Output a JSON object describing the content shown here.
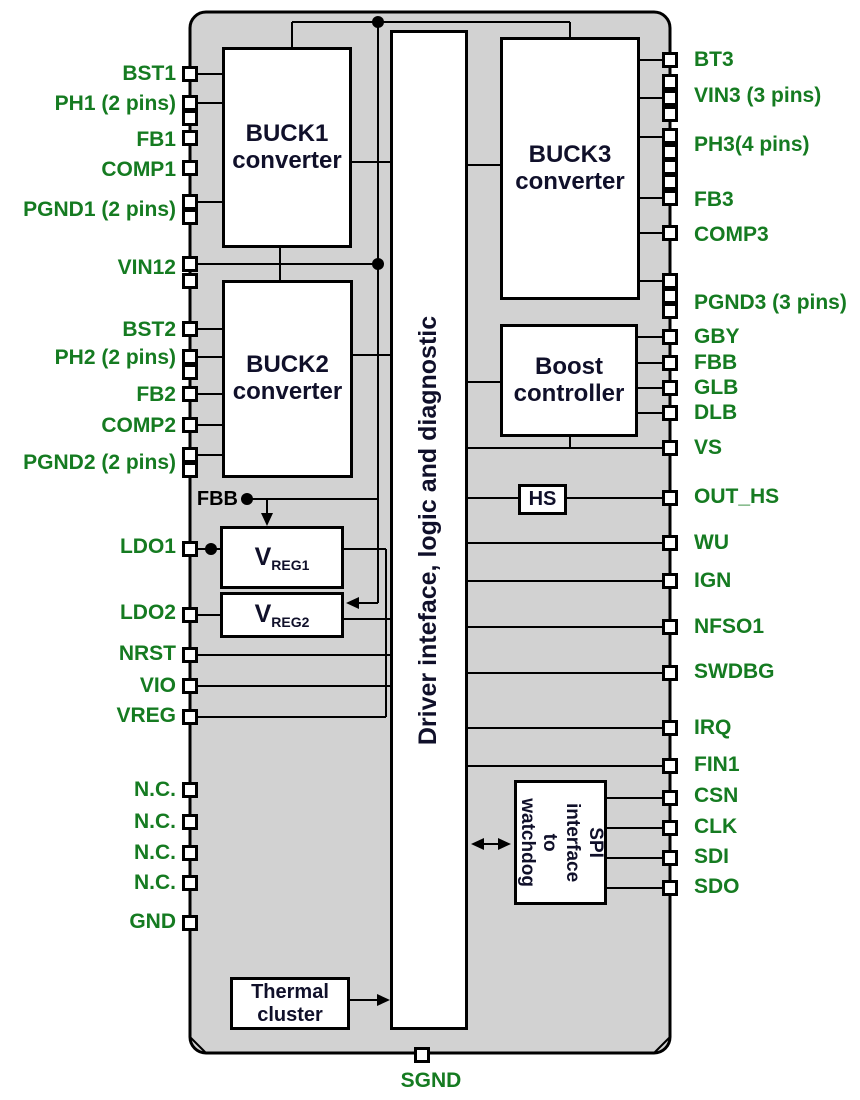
{
  "diagram": {
    "type": "ic-block-diagram",
    "colors": {
      "chip_fill": "#d2d2d2",
      "outline": "#000000",
      "block_fill": "#ffffff",
      "pin_label_green": "#157b21",
      "block_text": "#10102a"
    },
    "chip": {
      "x": 190,
      "y": 12,
      "w": 480,
      "h": 1041,
      "radius": 16
    },
    "blocks": [
      {
        "id": "buck1",
        "kind": "plain",
        "x": 222,
        "y": 47,
        "w": 130,
        "h": 201,
        "cls": "lbl-24",
        "label_lines": [
          "BUCK1",
          "converter"
        ]
      },
      {
        "id": "buck2",
        "kind": "plain",
        "x": 222,
        "y": 280,
        "w": 131,
        "h": 198,
        "cls": "lbl-24",
        "label_lines": [
          "BUCK2",
          "converter"
        ]
      },
      {
        "id": "buck3",
        "kind": "plain",
        "x": 500,
        "y": 37,
        "w": 140,
        "h": 263,
        "cls": "lbl-24",
        "label_lines": [
          "BUCK3",
          "converter"
        ]
      },
      {
        "id": "boost",
        "kind": "plain",
        "x": 500,
        "y": 324,
        "w": 138,
        "h": 113,
        "cls": "lbl-24",
        "label_lines": [
          "Boost",
          "controller"
        ]
      },
      {
        "id": "driver",
        "kind": "rot-ccw",
        "x": 390,
        "y": 30,
        "w": 78,
        "h": 1000,
        "label": "Driver inteface, logic and diagnostic"
      },
      {
        "id": "hs",
        "kind": "plain",
        "x": 518,
        "y": 484,
        "w": 49,
        "h": 31,
        "cls": "lbl-20",
        "label_lines": [
          "HS"
        ]
      },
      {
        "id": "vreg1",
        "kind": "vreg",
        "x": 220,
        "y": 526,
        "w": 124,
        "h": 63,
        "main": "V",
        "sub": "REG1"
      },
      {
        "id": "vreg2",
        "kind": "vreg",
        "x": 220,
        "y": 592,
        "w": 124,
        "h": 46,
        "main": "V",
        "sub": "REG2"
      },
      {
        "id": "spi",
        "kind": "rot-cw",
        "x": 514,
        "y": 780,
        "w": 93,
        "h": 125,
        "label_lines": [
          "SPI interface",
          "to",
          "watchdog"
        ]
      },
      {
        "id": "thermal",
        "kind": "plain",
        "x": 230,
        "y": 977,
        "w": 120,
        "h": 53,
        "cls": "lbl-20",
        "label_lines": [
          "Thermal",
          "cluster"
        ]
      }
    ],
    "pins": {
      "left": [
        {
          "label": "BST1",
          "label_y": 74,
          "squares": [
            74
          ]
        },
        {
          "label": "PH1 (2 pins)",
          "label_y": 104,
          "squares": [
            103,
            118
          ]
        },
        {
          "label": "FB1",
          "label_y": 140,
          "squares": [
            138
          ]
        },
        {
          "label": "COMP1",
          "label_y": 170,
          "squares": [
            168
          ]
        },
        {
          "label": "PGND1 (2 pins)",
          "label_y": 210,
          "squares": [
            202,
            217
          ]
        },
        {
          "label": "VIN12",
          "label_y": 268,
          "squares": [
            264,
            281
          ]
        },
        {
          "label": "BST2",
          "label_y": 330,
          "squares": [
            329
          ]
        },
        {
          "label": "PH2 (2 pins)",
          "label_y": 358,
          "squares": [
            357,
            372
          ]
        },
        {
          "label": "FB2",
          "label_y": 395,
          "squares": [
            394
          ]
        },
        {
          "label": "COMP2",
          "label_y": 426,
          "squares": [
            425
          ]
        },
        {
          "label": "PGND2 (2 pins)",
          "label_y": 463,
          "squares": [
            455,
            470
          ]
        },
        {
          "label": "LDO1",
          "label_y": 547,
          "squares": [
            549
          ]
        },
        {
          "label": "LDO2",
          "label_y": 613,
          "squares": [
            615
          ]
        },
        {
          "label": "NRST",
          "label_y": 654,
          "squares": [
            655
          ]
        },
        {
          "label": "VIO",
          "label_y": 686,
          "squares": [
            686
          ]
        },
        {
          "label": "VREG",
          "label_y": 716,
          "squares": [
            717
          ]
        },
        {
          "label": "N.C.",
          "label_y": 790,
          "squares": [
            790
          ]
        },
        {
          "label": "N.C.",
          "label_y": 822,
          "squares": [
            822
          ]
        },
        {
          "label": "N.C.",
          "label_y": 853,
          "squares": [
            853
          ]
        },
        {
          "label": "N.C.",
          "label_y": 883,
          "squares": [
            883
          ]
        },
        {
          "label": "GND",
          "label_y": 922,
          "squares": [
            923
          ]
        }
      ],
      "right": [
        {
          "label": "BT3",
          "label_y": 60,
          "squares": [
            60
          ]
        },
        {
          "label": "VIN3 (3 pins)",
          "label_y": 96,
          "squares": [
            82,
            98,
            114
          ]
        },
        {
          "label": "PH3(4 pins)",
          "label_y": 145,
          "squares": [
            136,
            152,
            167,
            182
          ]
        },
        {
          "label": "FB3",
          "label_y": 200,
          "squares": [
            198
          ]
        },
        {
          "label": "COMP3",
          "label_y": 235,
          "squares": [
            233
          ]
        },
        {
          "label": "PGND3 (3 pins)",
          "label_y": 303,
          "squares": [
            281,
            296,
            311
          ]
        },
        {
          "label": "GBY",
          "label_y": 337,
          "squares": [
            337
          ]
        },
        {
          "label": "FBB",
          "label_y": 363,
          "squares": [
            363
          ]
        },
        {
          "label": "GLB",
          "label_y": 388,
          "squares": [
            388
          ]
        },
        {
          "label": "DLB",
          "label_y": 413,
          "squares": [
            413
          ]
        },
        {
          "label": "VS",
          "label_y": 448,
          "squares": [
            448
          ]
        },
        {
          "label": "OUT_HS",
          "label_y": 497,
          "squares": [
            498
          ]
        },
        {
          "label": "WU",
          "label_y": 543,
          "squares": [
            543
          ]
        },
        {
          "label": "IGN",
          "label_y": 581,
          "squares": [
            581
          ]
        },
        {
          "label": "NFSO1",
          "label_y": 627,
          "squares": [
            627
          ]
        },
        {
          "label": "SWDBG",
          "label_y": 672,
          "squares": [
            673
          ]
        },
        {
          "label": "IRQ",
          "label_y": 728,
          "squares": [
            728
          ]
        },
        {
          "label": "FIN1",
          "label_y": 765,
          "squares": [
            766
          ]
        },
        {
          "label": "CSN",
          "label_y": 796,
          "squares": [
            798
          ]
        },
        {
          "label": "CLK",
          "label_y": 827,
          "squares": [
            828
          ]
        },
        {
          "label": "SDI",
          "label_y": 857,
          "squares": [
            858
          ]
        },
        {
          "label": "SDO",
          "label_y": 887,
          "squares": [
            888
          ]
        }
      ],
      "bottom": [
        {
          "label": "SGND",
          "label_x": 431,
          "label_y": 1081,
          "square_x": 422,
          "square_y": 1055
        }
      ]
    },
    "inner_labels": [
      {
        "text": "FBB",
        "align_right_x": 238,
        "y": 499
      }
    ],
    "wires": [
      [
        197,
        74,
        222,
        74
      ],
      [
        197,
        103,
        222,
        103
      ],
      [
        197,
        202,
        222,
        202
      ],
      [
        197,
        264,
        378,
        264
      ],
      [
        280,
        248,
        280,
        280
      ],
      [
        197,
        329,
        222,
        329
      ],
      [
        197,
        357,
        222,
        357
      ],
      [
        197,
        394,
        222,
        394
      ],
      [
        197,
        425,
        222,
        425
      ],
      [
        197,
        455,
        222,
        455
      ],
      [
        197,
        549,
        220,
        549
      ],
      [
        197,
        615,
        220,
        615
      ],
      [
        197,
        655,
        391,
        655
      ],
      [
        197,
        686,
        391,
        686
      ],
      [
        197,
        717,
        386,
        717
      ],
      [
        292,
        22,
        570,
        22
      ],
      [
        292,
        22,
        292,
        47
      ],
      [
        570,
        22,
        570,
        37
      ],
      [
        378,
        22,
        378,
        499
      ],
      [
        247,
        499,
        378,
        499
      ],
      [
        267,
        499,
        267,
        522
      ],
      [
        378,
        499,
        378,
        603
      ],
      [
        350,
        603,
        378,
        603
      ],
      [
        344,
        549,
        386,
        549
      ],
      [
        386,
        549,
        386,
        717
      ],
      [
        344,
        619,
        391,
        619
      ],
      [
        352,
        162,
        391,
        162
      ],
      [
        352,
        355,
        391,
        355
      ],
      [
        640,
        60,
        663,
        60
      ],
      [
        640,
        98,
        663,
        98
      ],
      [
        640,
        137,
        663,
        137
      ],
      [
        640,
        198,
        663,
        198
      ],
      [
        640,
        233,
        663,
        233
      ],
      [
        640,
        281,
        663,
        281
      ],
      [
        638,
        337,
        663,
        337
      ],
      [
        638,
        363,
        663,
        363
      ],
      [
        638,
        388,
        663,
        388
      ],
      [
        638,
        413,
        663,
        413
      ],
      [
        468,
        448,
        663,
        448
      ],
      [
        570,
        437,
        570,
        448
      ],
      [
        468,
        498,
        518,
        498
      ],
      [
        567,
        498,
        663,
        498
      ],
      [
        468,
        543,
        663,
        543
      ],
      [
        468,
        581,
        663,
        581
      ],
      [
        468,
        627,
        663,
        627
      ],
      [
        468,
        673,
        663,
        673
      ],
      [
        468,
        728,
        663,
        728
      ],
      [
        468,
        766,
        663,
        766
      ],
      [
        607,
        798,
        663,
        798
      ],
      [
        607,
        828,
        663,
        828
      ],
      [
        607,
        858,
        663,
        858
      ],
      [
        607,
        888,
        663,
        888
      ],
      [
        468,
        165,
        500,
        165
      ],
      [
        468,
        382,
        500,
        382
      ],
      [
        474,
        844,
        508,
        844
      ],
      [
        350,
        1000,
        386,
        1000
      ],
      [
        190,
        1037,
        206,
        1053
      ],
      [
        654,
        1053,
        670,
        1037
      ]
    ],
    "junction_dots": [
      [
        378,
        22
      ],
      [
        378,
        264
      ],
      [
        247,
        499
      ],
      [
        211,
        549
      ]
    ],
    "arrowheads": [
      {
        "x": 267,
        "y": 526,
        "dir": "down"
      },
      {
        "x": 346,
        "y": 603,
        "dir": "left"
      },
      {
        "x": 390,
        "y": 1000,
        "dir": "right"
      },
      {
        "x": 471,
        "y": 844,
        "dir": "left"
      },
      {
        "x": 511,
        "y": 844,
        "dir": "right"
      }
    ]
  }
}
